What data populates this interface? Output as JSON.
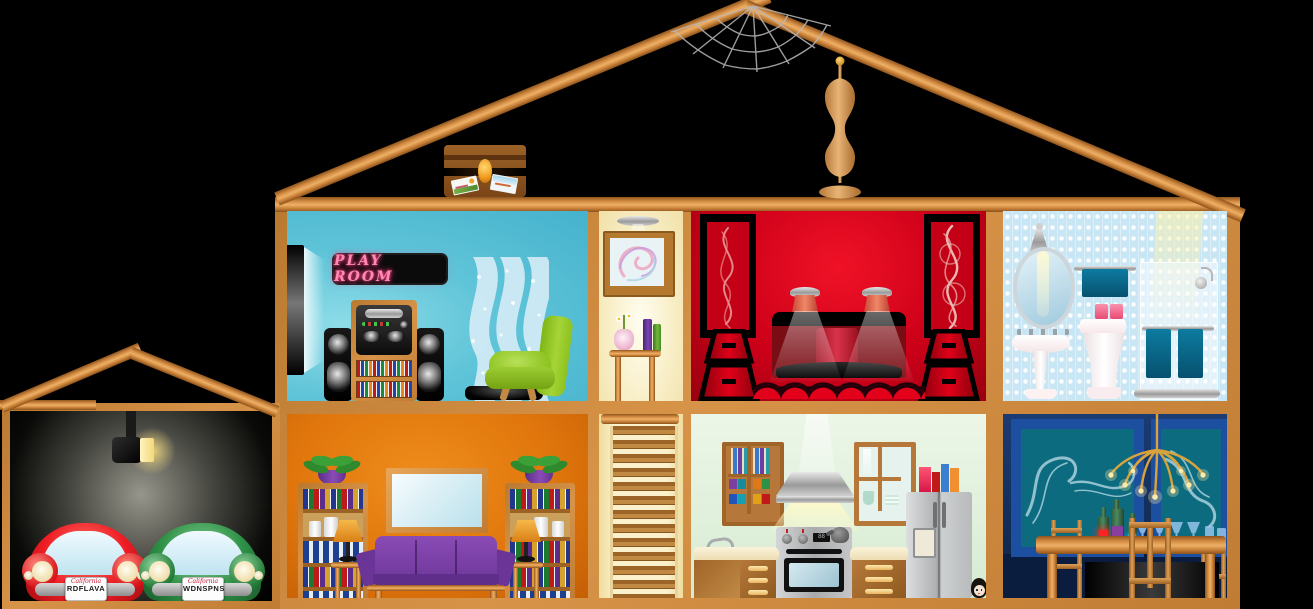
{
  "illustration": {
    "title": "dollhouse-cutaway",
    "background_color": "#000000",
    "wood_color": "#d9944a"
  },
  "attic": {
    "items": [
      "spider-web",
      "treasure-chest",
      "dress-form-mannequin"
    ]
  },
  "upper_floor": {
    "play_room": {
      "sign_text": "PLAY ROOM",
      "sign_color": "#ff8ab2",
      "wall_color": "#56bfd6",
      "items": [
        "flat-panel-tv",
        "neon-sign",
        "stereo-cabinet",
        "speaker-towers",
        "sparkle-curtains",
        "green-armchair",
        "black-ottoman"
      ]
    },
    "hallway": {
      "wall_color": "#f8eec6",
      "items": [
        "ceiling-lamp",
        "abstract-picture",
        "side-table",
        "flower-vase",
        "standing-books"
      ]
    },
    "red_media_room": {
      "wall_color": "#cc0019",
      "items": [
        "swirl-panel-left",
        "swirl-panel-right",
        "spotlight-lamps",
        "vanity-table",
        "folding-fans",
        "drawer-stand-left",
        "drawer-stand-right"
      ]
    },
    "bathroom": {
      "wall_color": "#c9e6f5",
      "towel_color": "#0a6d92",
      "items": [
        "sconce-light",
        "oval-mirror",
        "pedestal-sink",
        "hand-towel-rail",
        "toilet",
        "tissue-boxes",
        "shower-enclosure",
        "shower-head",
        "bath-towels"
      ]
    }
  },
  "lower_floor": {
    "living_room": {
      "wall_color": "#e0760c",
      "couch_color": "#7b3fa5",
      "items": [
        "bookcase-left",
        "bookcase-right",
        "potted-plant-left",
        "potted-plant-right",
        "table-lamp-left",
        "table-lamp-right",
        "purple-couch",
        "wall-screen"
      ]
    },
    "staircase": {
      "step_count": 13
    },
    "kitchen": {
      "wall_color": "#e3f1df",
      "items": [
        "wall-cabinet",
        "range-hood",
        "stove-oven",
        "window-cabinet",
        "refrigerator",
        "cereal-boxes",
        "sink-counter",
        "drawer-counter",
        "peeking-doll"
      ]
    },
    "dining_room": {
      "wall_color": "#16356b",
      "items": [
        "art-panel-left",
        "art-panel-right",
        "sputnik-chandelier",
        "dining-table",
        "wine-bottles",
        "glassware",
        "dining-chairs"
      ]
    }
  },
  "garage": {
    "wall_color": "#000000",
    "items": [
      "ceiling-light"
    ],
    "cars": [
      {
        "name": "red-car",
        "color": "#ee1c24",
        "plate_state": "California",
        "plate_text": "RDFLAVA"
      },
      {
        "name": "green-car",
        "color": "#2f9147",
        "plate_state": "California",
        "plate_text": "WDNSPNS"
      }
    ]
  }
}
